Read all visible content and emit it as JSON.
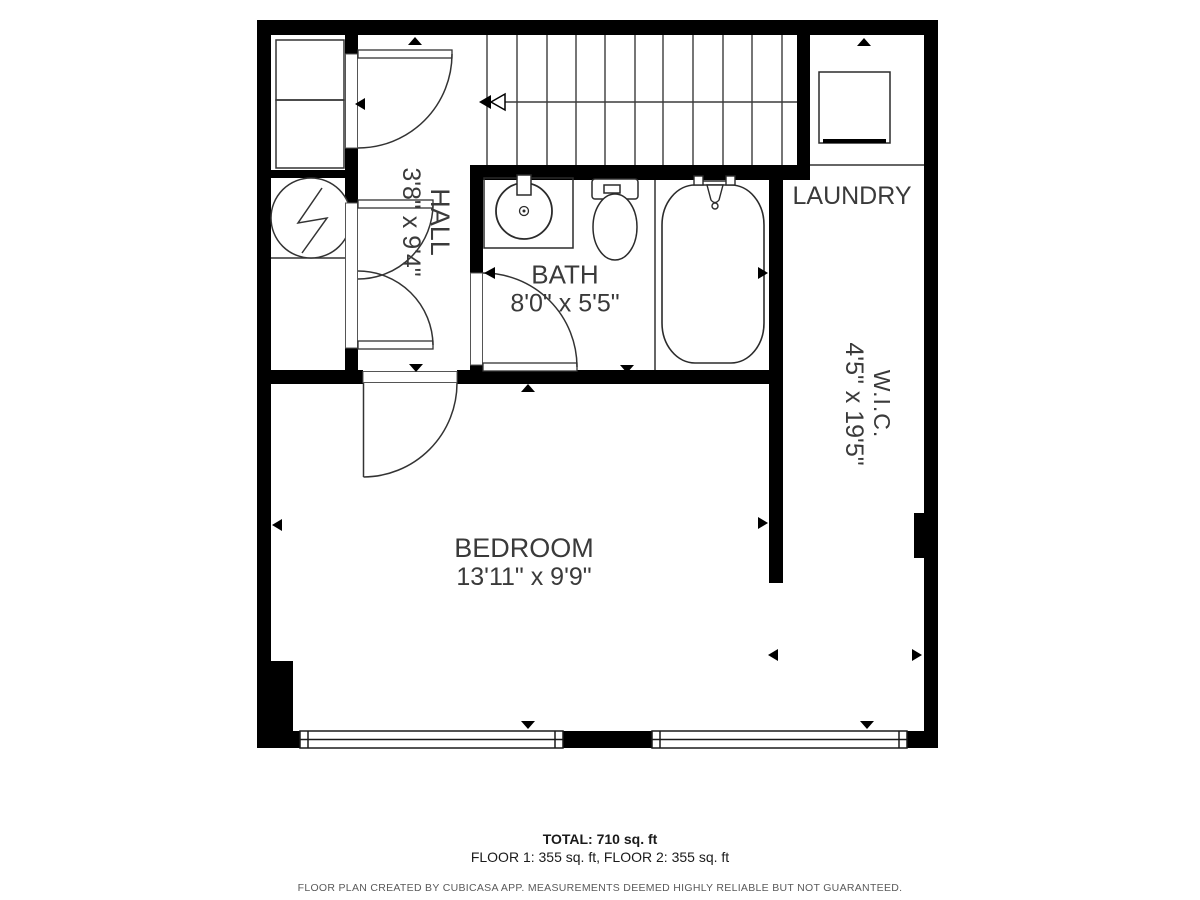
{
  "plan": {
    "rooms": {
      "hall": {
        "name": "HALL",
        "dims": "3'8\" x 9'4\""
      },
      "bath": {
        "name": "BATH",
        "dims": "8'0\" x 5'5\""
      },
      "bedroom": {
        "name": "BEDROOM",
        "dims": "13'11\" x 9'9\""
      },
      "laundry": {
        "name": "LAUNDRY"
      },
      "wic": {
        "name": "W.I.C.",
        "dims": "4'5\" x 19'5\""
      }
    },
    "fixtures": [
      "stairs",
      "bathtub",
      "toilet",
      "sink-vanity",
      "washer",
      "water-heater",
      "closet-shelves",
      "windows"
    ],
    "colors": {
      "wall": "#000000",
      "label": "#3a3a3a",
      "line": "#333333",
      "disclaimer": "#5a5a5a",
      "background": "#ffffff"
    }
  },
  "footer": {
    "total": "TOTAL: 710 sq. ft",
    "floors": "FLOOR 1: 355 sq. ft, FLOOR 2: 355 sq. ft",
    "disclaimer": "FLOOR PLAN CREATED BY CUBICASA APP. MEASUREMENTS DEEMED HIGHLY RELIABLE BUT NOT GUARANTEED."
  }
}
